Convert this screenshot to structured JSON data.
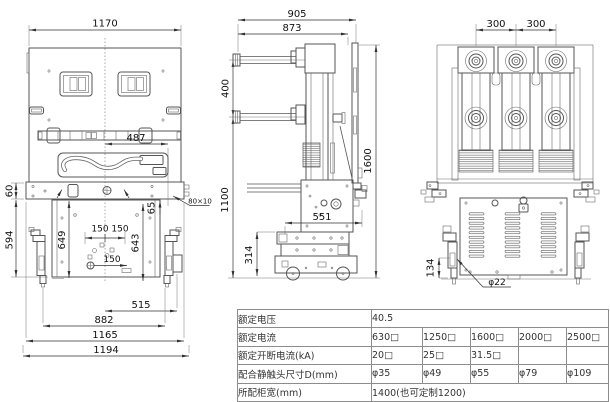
{
  "drawing": {
    "front_view": {
      "dims": {
        "total_width": "1170",
        "handle_offset": "487",
        "strip_height": "60",
        "lower_height": "594",
        "left_rail": "649",
        "hole_pitch_pair": "150 150",
        "right_rail": "643",
        "slot_offset": "65",
        "hole_pitch": "150",
        "span_inner": "515",
        "span_arms": "882",
        "span_strip": "1165",
        "span_total": "1194",
        "bar_note": "80×10"
      }
    },
    "side_view": {
      "dims": {
        "depth_total": "905",
        "depth_body": "873",
        "arm_pitch": "400",
        "height_total": "1600",
        "height_lower": "1100",
        "base_depth": "551",
        "base_height": "314"
      }
    },
    "rear_view": {
      "dims": {
        "pole_pitch_1": "300",
        "pole_pitch_2": "300",
        "pin_height": "134",
        "pin_dia": "φ22"
      }
    }
  },
  "spec_table": {
    "rows": [
      {
        "label": "额定电压",
        "span_value": "40.5"
      },
      {
        "label": "额定电流",
        "values": [
          "630□",
          "1250□",
          "1600□",
          "2000□",
          "2500□"
        ]
      },
      {
        "label": "额定开断电流(kA)",
        "values": [
          "20□",
          "25□",
          "31.5□",
          "",
          ""
        ]
      },
      {
        "label": "配合静触头尺寸D(mm)",
        "values": [
          "φ35",
          "φ49",
          "φ55",
          "φ79",
          "φ109"
        ]
      },
      {
        "label": "所配柜宽(mm)",
        "span_value": "1400(也可定制1200)"
      }
    ]
  }
}
